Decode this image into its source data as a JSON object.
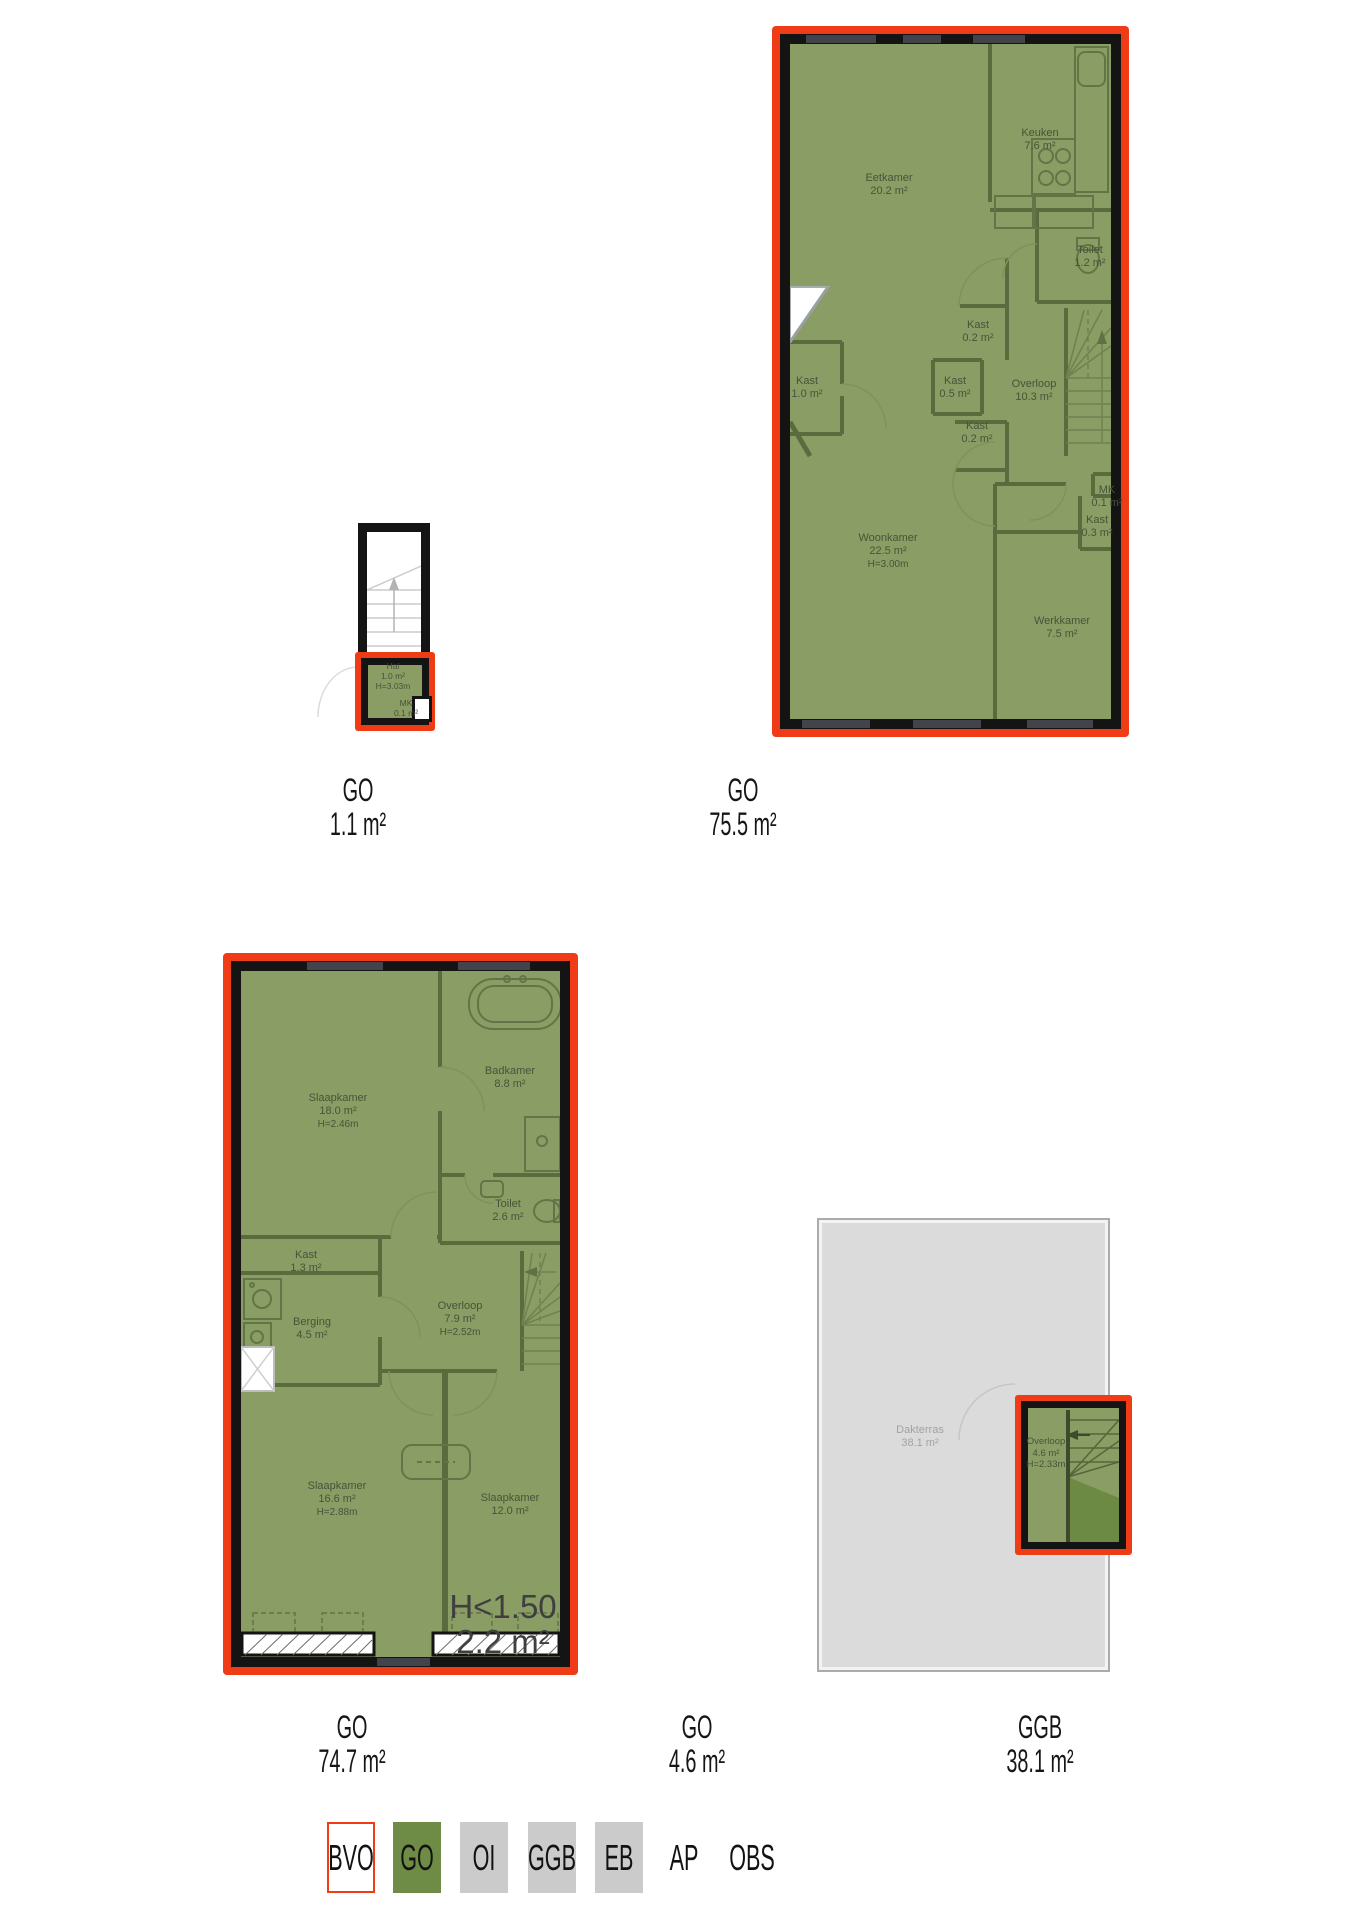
{
  "colors": {
    "bvo_red": "#ef3c17",
    "go_green": "#6e8c45",
    "floor_green": "#8a9d64",
    "wall_black": "#141414",
    "interior_wall_green": "#5a6c3d",
    "terrace_gray": "#dbdbdb",
    "legend_gray": "#cbcbcb"
  },
  "plans": {
    "hal": {
      "rooms": {
        "hal": {
          "name": "Hal",
          "area": "1.0 m²",
          "height": "H=3.03m"
        },
        "mk": {
          "name": "MK",
          "area": "0.1 m²"
        }
      },
      "label": {
        "code": "GO",
        "area": "1.1 m²"
      }
    },
    "first": {
      "rooms": {
        "eetkamer": {
          "name": "Eetkamer",
          "area": "20.2 m²"
        },
        "keuken": {
          "name": "Keuken",
          "area": "7.6 m²"
        },
        "toilet": {
          "name": "Toilet",
          "area": "1.2 m²"
        },
        "kast_a": {
          "name": "Kast",
          "area": "0.2 m²"
        },
        "kast_b": {
          "name": "Kast",
          "area": "1.0 m²"
        },
        "kast_c": {
          "name": "Kast",
          "area": "0.5 m²"
        },
        "kast_d": {
          "name": "Kast",
          "area": "0.2 m²"
        },
        "overloop": {
          "name": "Overloop",
          "area": "10.3 m²"
        },
        "mk": {
          "name": "MK",
          "area": "0.1 m²"
        },
        "kast_e": {
          "name": "Kast",
          "area": "0.3 m²"
        },
        "woonkamer": {
          "name": "Woonkamer",
          "area": "22.5 m²",
          "height": "H=3.00m"
        },
        "werkkamer": {
          "name": "Werkkamer",
          "area": "7.5 m²"
        }
      },
      "label": {
        "code": "GO",
        "area": "75.5 m²"
      }
    },
    "second": {
      "rooms": {
        "slaapkamer_a": {
          "name": "Slaapkamer",
          "area": "18.0 m²",
          "height": "H=2.46m"
        },
        "badkamer": {
          "name": "Badkamer",
          "area": "8.8 m²"
        },
        "toilet": {
          "name": "Toilet",
          "area": "2.6 m²"
        },
        "kast": {
          "name": "Kast",
          "area": "1.3 m²"
        },
        "berging": {
          "name": "Berging",
          "area": "4.5 m²"
        },
        "overloop": {
          "name": "Overloop",
          "area": "7.9 m²",
          "height": "H=2.52m"
        },
        "slaapkamer_b": {
          "name": "Slaapkamer",
          "area": "16.6 m²",
          "height": "H=2.88m"
        },
        "slaapkamer_c": {
          "name": "Slaapkamer",
          "area": "12.0 m²"
        }
      },
      "low": {
        "line1": "H<1.50",
        "line2": "2.2 m²"
      },
      "label": {
        "code": "GO",
        "area": "74.7 m²"
      }
    },
    "roof": {
      "rooms": {
        "dakterras": {
          "name": "Dakterras",
          "area": "38.1 m²"
        },
        "overloop": {
          "name": "Overloop",
          "area": "4.6 m²",
          "height": "H=2.33m"
        }
      },
      "label_go": {
        "code": "GO",
        "area": "4.6 m²"
      },
      "label_ggb": {
        "code": "GGB",
        "area": "38.1 m²"
      }
    }
  },
  "legend": {
    "items": [
      {
        "label": "BVO",
        "style": "bvo-red-outline"
      },
      {
        "label": "GO",
        "style": "green"
      },
      {
        "label": "OI",
        "style": "gray"
      },
      {
        "label": "GGB",
        "style": "gray"
      },
      {
        "label": "EB",
        "style": "gray"
      },
      {
        "label": "AP",
        "style": "none"
      },
      {
        "label": "OBS",
        "style": "none"
      }
    ]
  }
}
